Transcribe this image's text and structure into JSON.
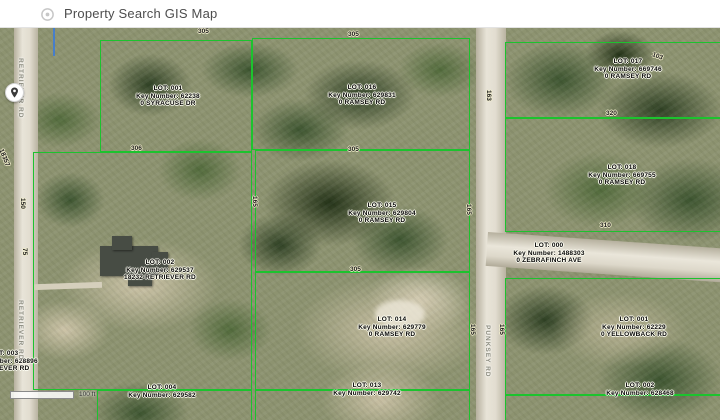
{
  "header": {
    "title": "Property Search GIS Map"
  },
  "map": {
    "scale_bar": {
      "label": "100 ft"
    },
    "roads": {
      "left": "RETRIEVER RD",
      "left_lower": "RETRIEVER RD",
      "right": "PUNKSEY RD"
    },
    "parcels": [
      {
        "lot": "LOT: 001",
        "key": "Key Number: 62238",
        "address": "0 SYRACUSE DR"
      },
      {
        "lot": "LOT: 016",
        "key": "Key Number: 629831",
        "address": "0 RAMSEY RD"
      },
      {
        "lot": "LOT: 017",
        "key": "Key Number: 669746",
        "address": "0 RAMSEY RD"
      },
      {
        "lot": "LOT: 002",
        "key": "Key Number: 629537",
        "address": "18232 RETRIEVER RD"
      },
      {
        "lot": "LOT: 015",
        "key": "Key Number: 629804",
        "address": "0 RAMSEY RD"
      },
      {
        "lot": "LOT: 018",
        "key": "Key Number: 669755",
        "address": "0 RAMSEY RD"
      },
      {
        "lot": "LOT: 000",
        "key": "Key Number: 1488303",
        "address": "0 ZEBRAFINCH AVE"
      },
      {
        "lot": "LOT: 014",
        "key": "Key Number: 629779",
        "address": "0 RAMSEY RD"
      },
      {
        "lot": "LOT: 001",
        "key": "Key Number: 62229",
        "address": "0 YELLOWBACK RD"
      },
      {
        "lot": "LOT: 004",
        "key": "Key Number: 629582",
        "address": ""
      },
      {
        "lot": "LOT: 013",
        "key": "Key Number: 629742",
        "address": ""
      },
      {
        "lot": "LOT: 002",
        "key": "Key Number: 628468",
        "address": ""
      },
      {
        "lot": "LOT: 003",
        "key": "Key Number: 628896",
        "address": "RETRIEVER RD"
      }
    ],
    "dimensions": [
      {
        "t": "305"
      },
      {
        "t": "305"
      },
      {
        "t": "306"
      },
      {
        "t": "305"
      },
      {
        "t": "305"
      },
      {
        "t": "165"
      },
      {
        "t": "165"
      },
      {
        "t": "165"
      },
      {
        "t": "165"
      },
      {
        "t": "163"
      },
      {
        "t": "150"
      },
      {
        "t": "75"
      },
      {
        "t": "320"
      },
      {
        "t": "310"
      },
      {
        "t": "103"
      },
      {
        "t": "18357"
      }
    ]
  }
}
